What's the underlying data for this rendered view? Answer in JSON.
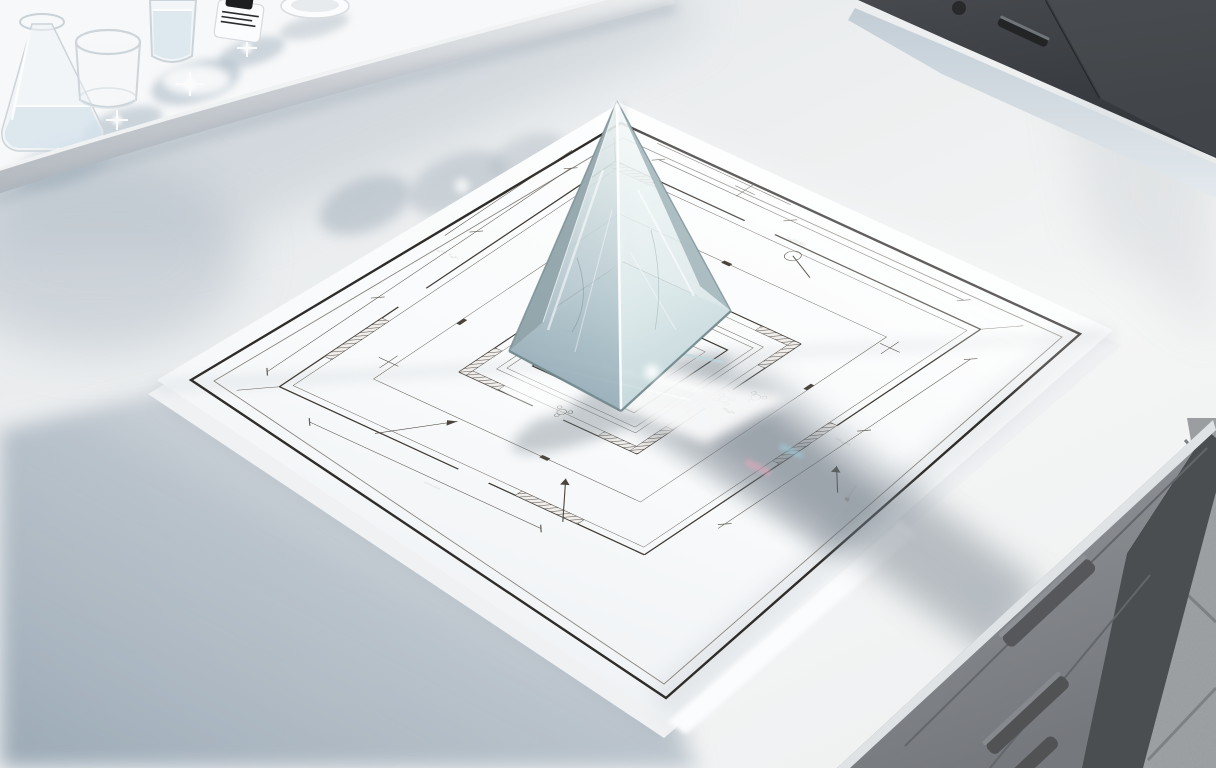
{
  "scene": {
    "kind": "photoreal render",
    "subject": "clear glass pyramid prism standing on an architectural floor-plan drawing on a sunlit white laboratory counter"
  },
  "objects": {
    "pyramid": "glass pyramid prism",
    "blueprint": "architectural floor plan sheet",
    "flask": "erlenmeyer flask with water",
    "beaker": "empty glass beaker",
    "tall_glass": "tall glass with water",
    "bottle": "small reagent bottle with black cap",
    "dish": "shallow white dish",
    "tray_rail": "shelf tray edge rail",
    "cabinet_top": "dark wall cabinet with bar handle",
    "cabinet_bottom": "grey under-counter drawer unit with bar handles",
    "floor": "speckled terrazzo floor tiles"
  },
  "annotations": {
    "note1": "·‥··· ·‥··",
    "note2": "·‥···⋯·",
    "note3": "········",
    "note4": "Δ·······",
    "note5": "··‥··",
    "note6": "···‥···",
    "note7": "·‥···"
  },
  "colors": {
    "paper": "#fcfdfe",
    "ink": "#3b362f",
    "glass_tint": "#cfe0e0",
    "shadow_blue": "#a9b4bf",
    "cabinet_dark": "#3d4043",
    "cabinet_gray": "#8b8e92",
    "floor_gray": "#9b9ea1",
    "table_light": "#eef0f1"
  }
}
